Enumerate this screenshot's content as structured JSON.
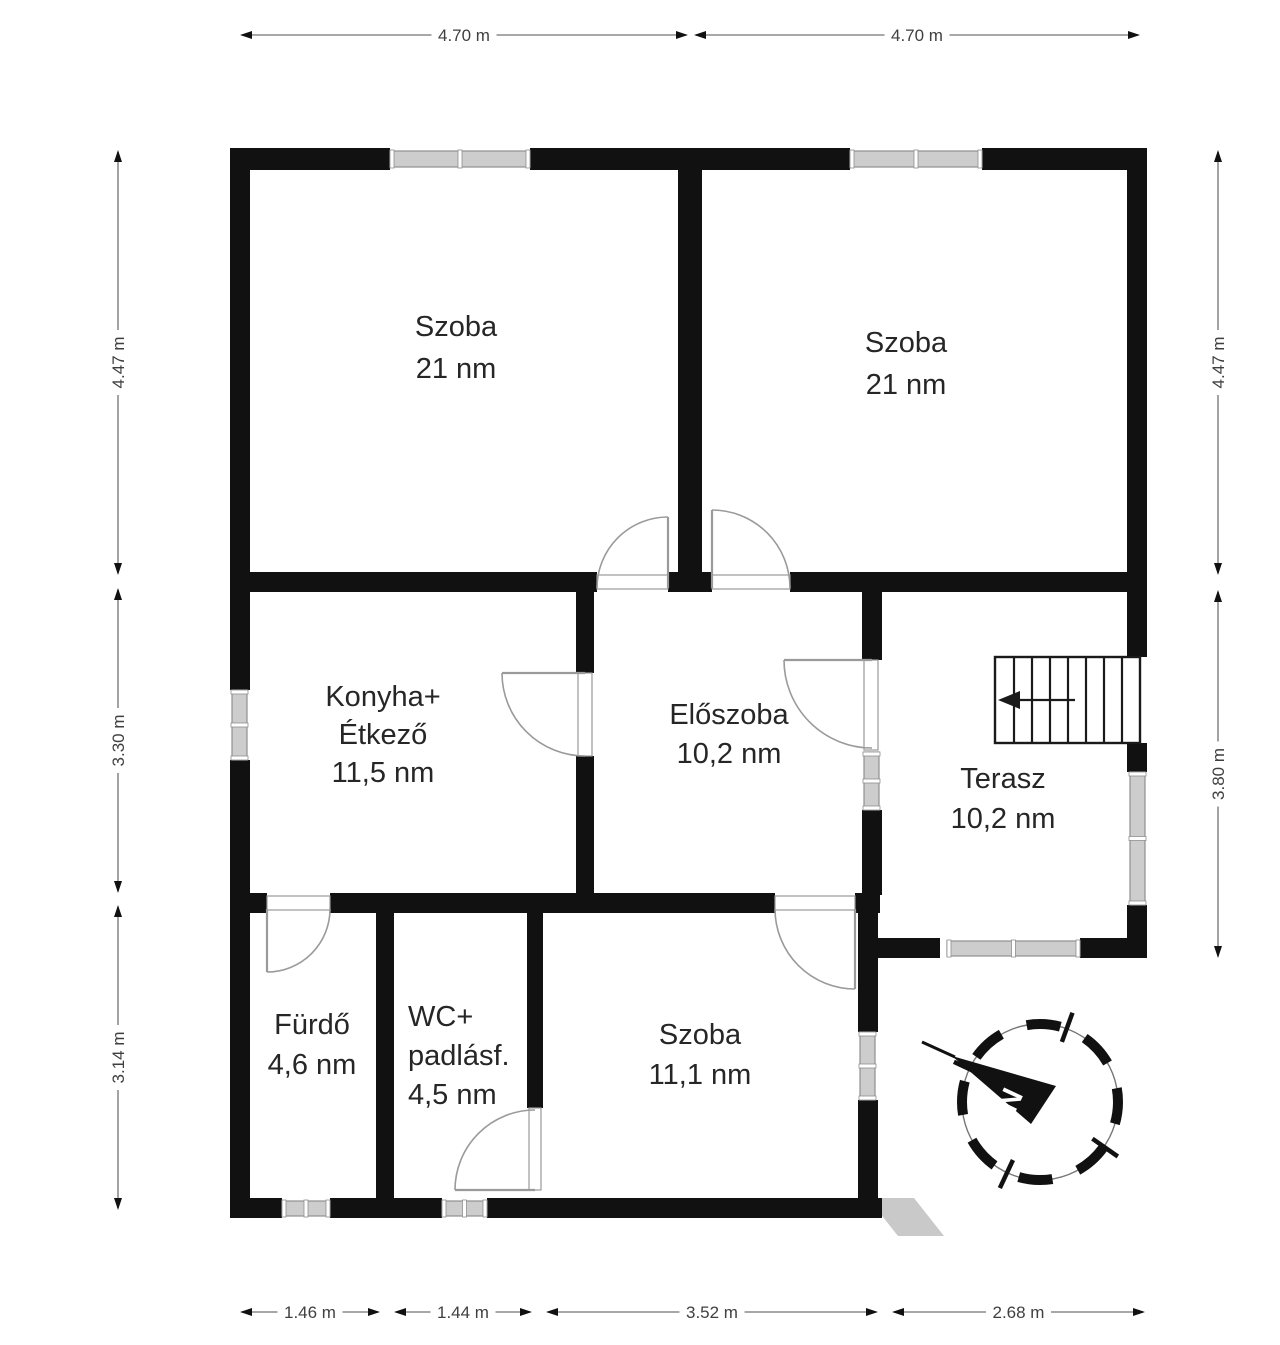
{
  "canvas": {
    "width": 1280,
    "height": 1345,
    "background": "#ffffff"
  },
  "colors": {
    "wall": "#111111",
    "window_fill": "#cdcdcd",
    "window_edge": "#8f8f8f",
    "window_tick": "#ffffff",
    "door": "#9a9a9a",
    "stairs": "#1a1a1a",
    "dim_line": "#8c8c8c",
    "dim_arrow": "#111111",
    "dim_text": "#3f3f3f",
    "label_text": "#262626",
    "wedge": "#c9c9c9",
    "compass": "#111111"
  },
  "rooms": [
    {
      "id": "szoba-1",
      "lines": [
        "Szoba",
        "21 nm"
      ],
      "x": 456,
      "y": 336,
      "lh": 42,
      "align": "center"
    },
    {
      "id": "szoba-2",
      "lines": [
        "Szoba",
        "21 nm"
      ],
      "x": 906,
      "y": 352,
      "lh": 42,
      "align": "center"
    },
    {
      "id": "konyha",
      "lines": [
        "Konyha+",
        "Étkező",
        "11,5 nm"
      ],
      "x": 383,
      "y": 706,
      "lh": 38,
      "align": "center"
    },
    {
      "id": "eloszoba",
      "lines": [
        "Előszoba",
        "10,2 nm"
      ],
      "x": 729,
      "y": 724,
      "lh": 39,
      "align": "center"
    },
    {
      "id": "terasz",
      "lines": [
        "Terasz",
        "10,2 nm"
      ],
      "x": 1003,
      "y": 788,
      "lh": 40,
      "align": "center"
    },
    {
      "id": "furdo",
      "lines": [
        "Fürdő",
        "4,6 nm"
      ],
      "x": 312,
      "y": 1034,
      "lh": 40,
      "align": "center"
    },
    {
      "id": "wc",
      "lines": [
        "WC+",
        "padlásf.",
        "4,5 nm"
      ],
      "x": 408,
      "y": 1026,
      "lh": 39,
      "align": "left"
    },
    {
      "id": "szoba-3",
      "lines": [
        "Szoba",
        "11,1 nm"
      ],
      "x": 700,
      "y": 1044,
      "lh": 40,
      "align": "center"
    }
  ],
  "dimensions": {
    "top": [
      {
        "label": "4.70 m",
        "from": 240,
        "to": 688,
        "at": 35
      },
      {
        "label": "4.70 m",
        "from": 694,
        "to": 1140,
        "at": 35
      }
    ],
    "bottom": [
      {
        "label": "1.46 m",
        "from": 240,
        "to": 380,
        "at": 1312
      },
      {
        "label": "1.44 m",
        "from": 394,
        "to": 532,
        "at": 1312
      },
      {
        "label": "3.52 m",
        "from": 546,
        "to": 878,
        "at": 1312
      },
      {
        "label": "2.68 m",
        "from": 892,
        "to": 1145,
        "at": 1312
      }
    ],
    "left": [
      {
        "label": "4.47 m",
        "from": 150,
        "to": 575,
        "at": 118
      },
      {
        "label": "3.30 m",
        "from": 588,
        "to": 893,
        "at": 118
      },
      {
        "label": "3.14 m",
        "from": 905,
        "to": 1210,
        "at": 118
      }
    ],
    "right": [
      {
        "label": "4.47 m",
        "from": 150,
        "to": 575,
        "at": 1218
      },
      {
        "label": "3.80 m",
        "from": 590,
        "to": 958,
        "at": 1218
      }
    ]
  },
  "walls": [
    [
      230,
      148,
      160,
      22
    ],
    [
      530,
      148,
      320,
      22
    ],
    [
      982,
      148,
      165,
      22
    ],
    [
      230,
      148,
      20,
      542
    ],
    [
      230,
      760,
      20,
      458
    ],
    [
      1127,
      148,
      20,
      440
    ],
    [
      678,
      170,
      24,
      402
    ],
    [
      230,
      572,
      367,
      20
    ],
    [
      668,
      572,
      44,
      20
    ],
    [
      790,
      572,
      357,
      20
    ],
    [
      576,
      592,
      18,
      81
    ],
    [
      576,
      756,
      18,
      137
    ],
    [
      862,
      592,
      20,
      68
    ],
    [
      862,
      810,
      20,
      85
    ],
    [
      1127,
      588,
      20,
      69
    ],
    [
      1127,
      743,
      20,
      29
    ],
    [
      1127,
      905,
      20,
      53
    ],
    [
      877,
      938,
      63,
      20
    ],
    [
      1080,
      938,
      67,
      20
    ],
    [
      230,
      893,
      37,
      20
    ],
    [
      330,
      893,
      445,
      20
    ],
    [
      855,
      893,
      25,
      20
    ],
    [
      376,
      913,
      18,
      285
    ],
    [
      527,
      913,
      16,
      195
    ],
    [
      858,
      893,
      20,
      139
    ],
    [
      858,
      1100,
      20,
      118
    ],
    [
      230,
      1198,
      52,
      20
    ],
    [
      330,
      1198,
      112,
      20
    ],
    [
      487,
      1198,
      395,
      20
    ]
  ],
  "windows": [
    {
      "r": [
        390,
        151,
        140,
        16
      ],
      "o": "h"
    },
    {
      "r": [
        850,
        151,
        132,
        16
      ],
      "o": "h"
    },
    {
      "r": [
        232,
        690,
        15,
        70
      ],
      "o": "v"
    },
    {
      "r": [
        864,
        752,
        15,
        58
      ],
      "o": "v"
    },
    {
      "r": [
        1130,
        772,
        15,
        133
      ],
      "o": "v"
    },
    {
      "r": [
        947,
        941,
        133,
        15
      ],
      "o": "h"
    },
    {
      "r": [
        282,
        1201,
        48,
        15
      ],
      "o": "h"
    },
    {
      "r": [
        442,
        1201,
        45,
        15
      ],
      "o": "h"
    },
    {
      "r": [
        860,
        1032,
        15,
        68
      ],
      "o": "v"
    }
  ],
  "doors": [
    {
      "id": "door-szoba-1",
      "jamb": [
        597,
        575,
        71,
        14
      ],
      "leaf": [
        668,
        588,
        668,
        517
      ],
      "arc": "M 597 588 A 71 71 0 0 1 668 517"
    },
    {
      "id": "door-szoba-2",
      "jamb": [
        712,
        575,
        78,
        14
      ],
      "leaf": [
        712,
        588,
        712,
        510
      ],
      "arc": "M 712 510 A 78 78 0 0 1 790 588"
    },
    {
      "id": "door-furdo",
      "jamb": [
        267,
        896,
        63,
        14
      ],
      "leaf": [
        267,
        909,
        267,
        972
      ],
      "arc": "M 330 909 A 63 63 0 0 1 267 972"
    },
    {
      "id": "door-konyha",
      "jamb": [
        578,
        673,
        14,
        83
      ],
      "leaf": [
        585,
        673,
        502,
        673
      ],
      "arc": "M 502 673 A 83 83 0 0 0 585 756"
    },
    {
      "id": "door-eloszoba",
      "jamb": [
        864,
        660,
        14,
        90
      ],
      "leaf": [
        872,
        660,
        784,
        660
      ],
      "arc": "M 784 660 A 88 88 0 0 0 872 748"
    },
    {
      "id": "door-szoba-3",
      "jamb": [
        775,
        896,
        80,
        14
      ],
      "leaf": [
        855,
        909,
        855,
        989
      ],
      "arc": "M 775 909 A 80 80 0 0 0 855 989"
    },
    {
      "id": "door-wc",
      "jamb": [
        529,
        1108,
        12,
        82
      ],
      "leaf": [
        535,
        1190,
        455,
        1190
      ],
      "arc": "M 535 1110 A 80 80 0 0 0 455 1190"
    }
  ],
  "stairs": {
    "rect": [
      995,
      657,
      145,
      86
    ],
    "treads_x": [
      1014,
      1032,
      1050,
      1068,
      1086,
      1104,
      1122
    ],
    "arrow_tip": [
      998,
      700
    ],
    "arrow_wings": [
      [
        1020,
        691
      ],
      [
        1020,
        709
      ]
    ],
    "stem": [
      1020,
      700,
      1075,
      700
    ]
  },
  "wedge_points": "868,1198 914,1198 944,1236 898,1236",
  "compass": {
    "label": "N",
    "center": [
      1040,
      1102
    ],
    "ring_radius": 78,
    "ring_dash": "34 27",
    "spike_angles_deg": [
      -70,
      35,
      115,
      -155
    ],
    "needle_points": "952,1056 1056,1086 1031,1124",
    "needle_tail": [
      922,
      1042,
      955,
      1057
    ],
    "label_pos": [
      1010,
      1100
    ],
    "label_rotation": -65
  }
}
